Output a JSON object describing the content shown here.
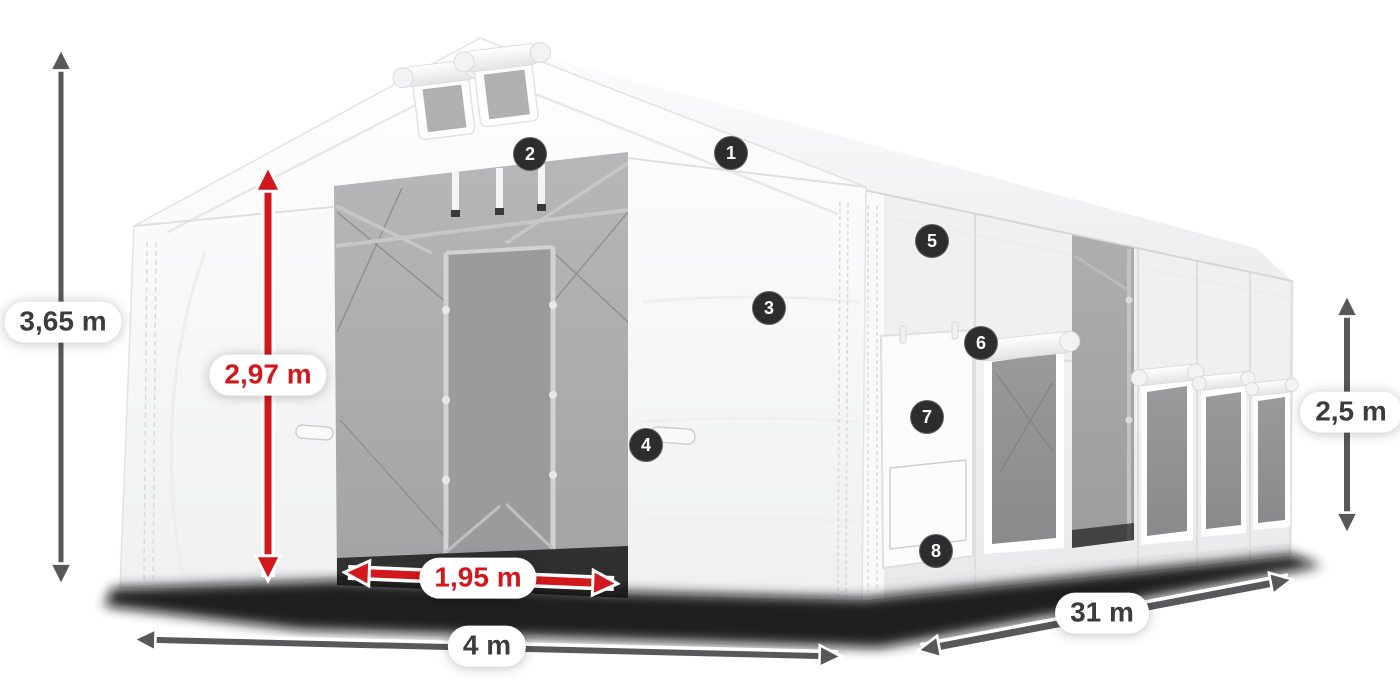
{
  "diagram": {
    "subject": "White PVC storage tent shown in perspective with numbered part callouts and dimension arrows",
    "dimension_labels": {
      "total_height": "3,65 m",
      "entrance_height": "2,97 m",
      "entrance_width": "1,95 m",
      "gable_width": "4 m",
      "length": "31 m",
      "side_height": "2,5 m"
    },
    "callouts": [
      {
        "number": "1"
      },
      {
        "number": "2"
      },
      {
        "number": "3"
      },
      {
        "number": "4"
      },
      {
        "number": "5"
      },
      {
        "number": "6"
      },
      {
        "number": "7"
      },
      {
        "number": "8"
      }
    ],
    "colors": {
      "dimension_red": "#d2181c",
      "dimension_gray": "#58585a",
      "callout_badge_bg": "#2d2d2f",
      "callout_badge_text": "#ffffff",
      "label_pill_bg": "#ffffff",
      "label_text_dark": "#3c3c3e",
      "tent_white": "#f5f5f7",
      "interior_gray": "#a8a8aa"
    }
  }
}
